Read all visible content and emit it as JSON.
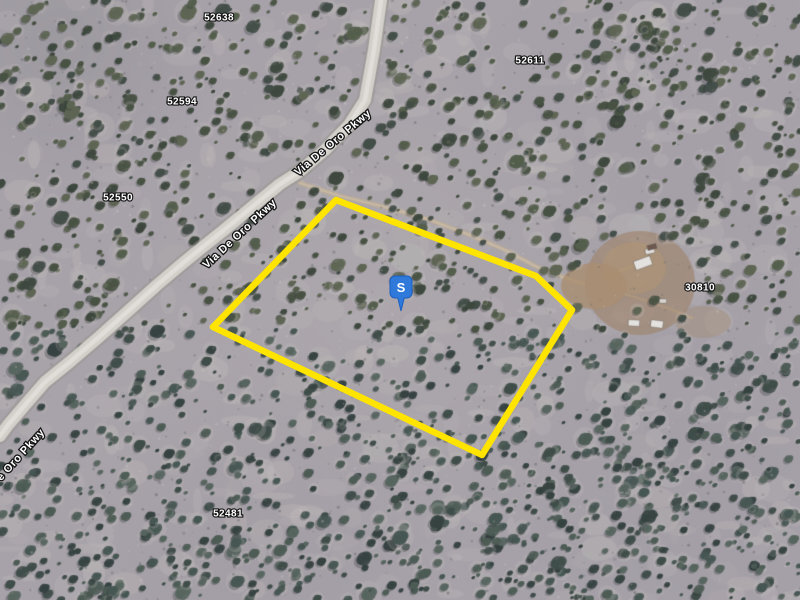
{
  "view": {
    "type": "satellite-imagery",
    "width": 800,
    "height": 600
  },
  "map": {
    "background": {
      "ground": "#a9a4aa",
      "ground_light": "#cbc5c1",
      "ground_dark": "#8e8a91",
      "bush_palette_north": [
        "#45503f",
        "#3a4539",
        "#525c48",
        "#404b44",
        "#5c6450"
      ],
      "bush_palette_south": [
        "#3c4a45",
        "#32403d",
        "#4a5a52",
        "#445550",
        "#55645c"
      ],
      "road_fill": "#d7d4cd",
      "road_edge": "rgba(150,147,140,0.55)",
      "road_center": "rgba(236,234,228,0.7)",
      "dirt_track": "rgba(196,176,146,0.6)"
    },
    "road": {
      "name": "Via De Oro Pkwy",
      "path": [
        [
          381,
          0
        ],
        [
          374,
          50
        ],
        [
          365,
          100
        ],
        [
          349,
          125
        ],
        [
          325,
          150
        ],
        [
          299,
          172
        ],
        [
          280,
          184
        ],
        [
          252,
          207
        ],
        [
          224,
          230
        ],
        [
          199,
          250
        ],
        [
          183,
          263
        ],
        [
          157,
          285
        ],
        [
          127,
          312
        ],
        [
          99,
          337
        ],
        [
          71,
          361
        ],
        [
          45,
          382
        ],
        [
          25,
          405
        ],
        [
          8,
          425
        ],
        [
          0,
          436
        ]
      ]
    },
    "tracks": [
      {
        "path": [
          [
            300,
            183
          ],
          [
            340,
            196
          ],
          [
            385,
            207
          ],
          [
            430,
            220
          ],
          [
            470,
            235
          ],
          [
            505,
            250
          ],
          [
            535,
            266
          ],
          [
            562,
            277
          ],
          [
            585,
            284
          ]
        ],
        "width": 5
      },
      {
        "path": [
          [
            598,
            287
          ],
          [
            635,
            297
          ],
          [
            668,
            308
          ],
          [
            692,
            318
          ]
        ],
        "width": 3
      },
      {
        "path": [
          [
            600,
            280
          ],
          [
            622,
            270
          ],
          [
            640,
            263
          ]
        ],
        "width": 3
      }
    ],
    "cleared_areas": [
      {
        "cx": 640,
        "cy": 283,
        "rx": 55,
        "ry": 52,
        "color": "#9f8368",
        "alpha": 0.62
      },
      {
        "cx": 634,
        "cy": 268,
        "rx": 32,
        "ry": 26,
        "color": "#b3976f",
        "alpha": 0.5
      },
      {
        "cx": 594,
        "cy": 286,
        "rx": 33,
        "ry": 23,
        "color": "#ab8f6f",
        "alpha": 0.8
      },
      {
        "cx": 703,
        "cy": 322,
        "rx": 28,
        "ry": 16,
        "color": "#a58a6d",
        "alpha": 0.4
      }
    ],
    "structures": [
      {
        "x": 643,
        "y": 263,
        "w": 17,
        "h": 9,
        "rot": -20,
        "color": "#e9e7e3"
      },
      {
        "x": 650,
        "y": 251,
        "w": 9,
        "h": 5,
        "rot": -12,
        "color": "#e9e7e3"
      },
      {
        "x": 634,
        "y": 323,
        "w": 11,
        "h": 6,
        "rot": 3,
        "color": "#e9e7e3"
      },
      {
        "x": 657,
        "y": 324,
        "w": 12,
        "h": 7,
        "rot": 8,
        "color": "#e9e7e3"
      },
      {
        "x": 663,
        "y": 301,
        "w": 7,
        "h": 4,
        "rot": 0,
        "color": "#ded9d2"
      },
      {
        "x": 652,
        "y": 247,
        "w": 9,
        "h": 5,
        "rot": -15,
        "color": "#6b564b"
      }
    ],
    "parcel": {
      "outline_color": "#ffe400",
      "stroke_width": 6.5,
      "points": [
        [
          336,
          200
        ],
        [
          536,
          276
        ],
        [
          572,
          310
        ],
        [
          482,
          455
        ],
        [
          213,
          327
        ]
      ]
    },
    "marker": {
      "label": "S",
      "x": 401,
      "y": 288,
      "fill": "#2e79da",
      "stroke": "#1b5fc0"
    },
    "road_labels": [
      {
        "text": "Via De Oro Pkwy",
        "x": 333,
        "y": 143,
        "rotation": -40
      },
      {
        "text": "Via De Oro Pkwy",
        "x": 240,
        "y": 234,
        "rotation": -43
      },
      {
        "text": "e Oro Pkwy",
        "x": 21,
        "y": 455,
        "rotation": -48
      }
    ],
    "parcel_labels": [
      {
        "text": "52638",
        "x": 219,
        "y": 18
      },
      {
        "text": "52611",
        "x": 530,
        "y": 61
      },
      {
        "text": "52594",
        "x": 182,
        "y": 102
      },
      {
        "text": "52550",
        "x": 118,
        "y": 198
      },
      {
        "text": "30810",
        "x": 700,
        "y": 288
      },
      {
        "text": "52481",
        "x": 228,
        "y": 514
      }
    ]
  }
}
